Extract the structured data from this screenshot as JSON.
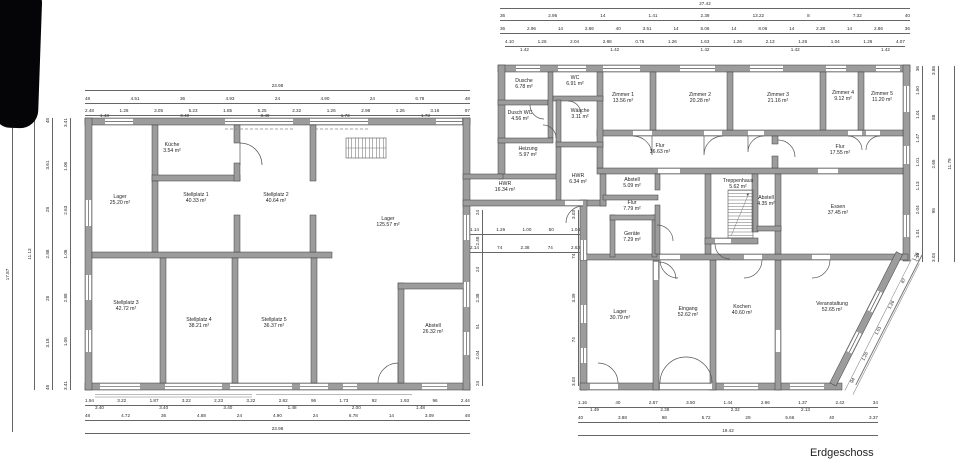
{
  "plan": {
    "title": "Erdgeschoss",
    "colors": {
      "wall": "#9c9c9c",
      "wall_edge": "#3f3f3f",
      "line": "#555555",
      "text": "#1f1f1f",
      "dim": "#2a2a2a",
      "bg": "#ffffff"
    },
    "rooms": {
      "kueche": {
        "name": "Küche",
        "area": "3.54 m²"
      },
      "lager1": {
        "name": "Lager",
        "area": "25.20 m²"
      },
      "stellplatz1": {
        "name": "Stellplatz 1",
        "area": "40.33 m²"
      },
      "stellplatz2": {
        "name": "Stellplatz 2",
        "area": "40.64 m²"
      },
      "lager125": {
        "name": "Lager",
        "area": "125.57 m²"
      },
      "stellplatz3": {
        "name": "Stellplatz 3",
        "area": "42.72 m²"
      },
      "stellplatz4": {
        "name": "Stellplatz 4",
        "area": "38.21 m²"
      },
      "stellplatz5": {
        "name": "Stellplatz 5",
        "area": "36.37 m²"
      },
      "abstell26": {
        "name": "Abstell",
        "area": "26.32 m²"
      },
      "dusche": {
        "name": "Dusche",
        "area": "6.78 m²"
      },
      "wc": {
        "name": "WC",
        "area": "6.91 m²"
      },
      "waesche": {
        "name": "Wäsche",
        "area": "3.11 m²"
      },
      "duschwc": {
        "name": "Dusch WC",
        "area": "4.56 m²"
      },
      "heizung": {
        "name": "Heizung",
        "area": "5.97 m²"
      },
      "hwr16": {
        "name": "HWR",
        "area": "16.34 m²"
      },
      "hwr6": {
        "name": "HWR",
        "area": "6.34 m²"
      },
      "zimmer1": {
        "name": "Zimmer 1",
        "area": "13.56 m²"
      },
      "zimmer2": {
        "name": "Zimmer 2",
        "area": "20.28 m²"
      },
      "zimmer3": {
        "name": "Zimmer 3",
        "area": "21.16 m²"
      },
      "zimmer4": {
        "name": "Zimmer 4",
        "area": "9.12 m²"
      },
      "zimmer5": {
        "name": "Zimmer 5",
        "area": "11.20 m²"
      },
      "flur_a": {
        "name": "Flur",
        "area": "36.63 m²"
      },
      "flur_b": {
        "name": "Flur",
        "area": "17.55 m²"
      },
      "abstell5": {
        "name": "Abstell",
        "area": "5.09 m²"
      },
      "flur_c": {
        "name": "Flur",
        "area": "7.79 m²"
      },
      "geraete": {
        "name": "Geräte",
        "area": "7.29 m²"
      },
      "treppenhaus": {
        "name": "Treppenhaus",
        "area": "5.62 m²"
      },
      "abstell4": {
        "name": "Abstell",
        "area": "4.35 m²"
      },
      "essen": {
        "name": "Essen",
        "area": "37.45 m²"
      },
      "lager30": {
        "name": "Lager",
        "area": "30.79 m²"
      },
      "eingang": {
        "name": "Eingang",
        "area": "52.62 m²"
      },
      "kochen": {
        "name": "Kochen",
        "area": "40.60 m²"
      },
      "veranstaltung": {
        "name": "Veranstaltung",
        "area": "52.65 m²"
      }
    },
    "dims": {
      "rb_top_overall": "27.42",
      "rb_top_row2": [
        "36",
        "2.96",
        "14",
        "1.41",
        "2.39",
        "13.22",
        "8",
        "7.32",
        "40"
      ],
      "rb_top_row3": [
        "36",
        "2.96",
        "14",
        "2.86",
        "40",
        "3.51",
        "14",
        "5.06",
        "14",
        "8.06",
        "14",
        "2.28",
        "14",
        "2.86",
        "36"
      ],
      "rb_top_row4": [
        "4.10",
        "1.26",
        "2.04",
        "2.88",
        "0.75",
        "1.26",
        "1.63",
        "1.26",
        "2.13",
        "1.26",
        "1.04",
        "1.26",
        "4.07"
      ],
      "rb_top_sills": [
        "1.42",
        "1.42",
        "1.42",
        "1.42",
        "1.42"
      ],
      "lb_top_overall": "23.98",
      "lb_top_row2": [
        "48",
        "4.51",
        "36",
        "4.93",
        "24",
        "4.90",
        "24",
        "6.78",
        "48"
      ],
      "lb_top_row3": [
        "2.48",
        "1.26",
        "3.05",
        "5.23",
        "1.85",
        "5.25",
        "2.32",
        "1.26",
        "2.98",
        "1.26",
        "3.16",
        "97"
      ],
      "lb_top_sub": [
        "1.43",
        "3.40",
        "3.40",
        "1.73",
        "1.73"
      ],
      "lb_bottom_row1": [
        "1.94",
        "3.22",
        "1.87",
        "3.22",
        "2.23",
        "3.22",
        "2.82",
        "96",
        "1.73",
        "92",
        "1.93",
        "96",
        "2.44"
      ],
      "lb_bottom_sub": [
        "3.40",
        "3.40",
        "3.40",
        "1.48",
        "2.00",
        "1.48"
      ],
      "lb_bottom_row2": [
        "48",
        "4.72",
        "36",
        "4.88",
        "24",
        "4.90",
        "24",
        "6.78",
        "14",
        "3.09",
        "48"
      ],
      "lb_bottom_overall": "23.98",
      "rb_bottom_row1": [
        "1.16",
        "40",
        "2.87",
        "3.50",
        "1.44",
        "2.96",
        "1.37",
        "2.42",
        "34"
      ],
      "rb_bottom_sub": [
        "1.49",
        "2.38",
        "2.32",
        "2.13"
      ],
      "rb_bottom_row2": [
        "40",
        "3.88",
        "98",
        "5.72",
        "29",
        "5.66",
        "40",
        "3.37"
      ],
      "rb_bottom_overall": "19.42",
      "left_site": "17.87",
      "left_overall": "11.13",
      "left_chain1": [
        "48",
        "3.18",
        "28",
        "2.88",
        "28",
        "3.61",
        "48"
      ],
      "left_chain2": [
        "3.41",
        "1.06",
        "2.88",
        "1.06",
        "2.63",
        "1.06",
        "3.41"
      ],
      "right_chain1": [
        "1.16",
        "1.01",
        "2.04",
        "1.13",
        "1.01",
        "1.47",
        "1.01",
        "1.50",
        "36"
      ],
      "right_chain2": [
        "3.03",
        "98",
        "2.65",
        "88",
        "3.88"
      ],
      "right_overall": "11.79",
      "mid_chain1": [
        "1.14",
        "1.26",
        "1.00",
        "50",
        "1.04"
      ],
      "mid_chain2": [
        "2.14",
        "74",
        "2.38",
        "74",
        "2.63"
      ],
      "mid_vchain1": [
        "24",
        "2.04",
        "51",
        "2.38",
        "24",
        "2.48",
        "24"
      ],
      "mid_vchain2": [
        "3.03",
        "74",
        "3.39",
        "74",
        "3.03"
      ],
      "diag_chain": [
        "94",
        "1.26",
        "1.01",
        "1.26",
        "87",
        "1.26"
      ]
    }
  }
}
